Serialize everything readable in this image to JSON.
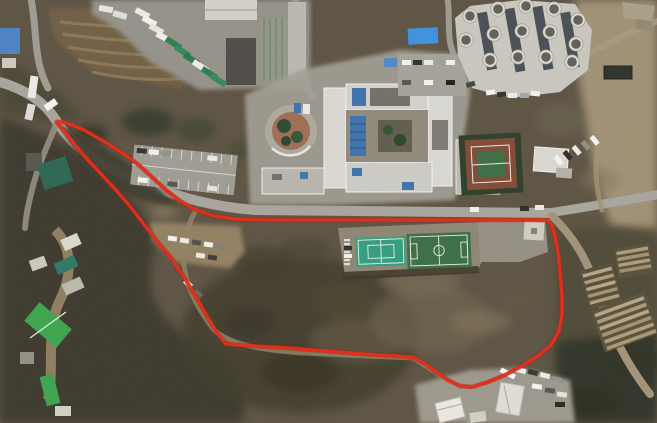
{
  "map": {
    "kind": "satellite-aerial-photo",
    "description": "Aerial photograph of a hillside campus with a main building complex, round-tank facility, tennis court, sports fields and farm plots, overlaid with a red site-boundary outline",
    "canvas": {
      "width": 657,
      "height": 423
    }
  },
  "boundary": {
    "label": "site-boundary-outline",
    "color": "#e2301c",
    "underlay_color": "#8c1d10",
    "stroke_width": 3.4,
    "points": "57,122 63,122 72,125 84,130 98,138 113,147 127,156 140,166 153,178 166,190 180,201 196,210 214,216 236,219 268,220 548,220 552,226 555,236 558,252 560,272 562,295 562,314 559,331 551,345 538,356 522,366 505,375 488,382 472,387 460,386 448,380 436,372 424,363 414,358 396,356 362,354 326,351 288,348 254,346 226,344 217,333 207,316 196,297 184,277 171,258 157,241 143,223 129,205 115,189 101,174 88,160 76,146 66,133 59,125 57,122"
  },
  "features": {
    "terrain": {
      "label": "scrub hillside",
      "base_color": "#5b5244",
      "dark_color": "#38352b",
      "bare_color": "#9c8d72"
    },
    "roads": {
      "label": "access roads",
      "color": "#a4a19a",
      "dirt_color": "#9c8f76"
    },
    "main_building": {
      "label": "main building complex",
      "roof_color": "#d6d5cf",
      "solar_color": "#3f6fa8",
      "courtyard_color": "#8b8578"
    },
    "tank_facility": {
      "label": "round tank facility",
      "pad_color": "#c6c4bc",
      "tank_rim_color": "#d8d6cf",
      "tank_color": "#5f5d57"
    },
    "soccer_field": {
      "label": "soccer field",
      "turf_color": "#3c6b45",
      "line_color": "#dfe8dc"
    },
    "futsal_court": {
      "label": "futsal court",
      "turf_color": "#35997b",
      "line_color": "#e4efe7"
    },
    "tennis_court": {
      "label": "tennis court",
      "surface_color": "#7c4a38",
      "infield_color": "#3d6b44"
    },
    "greenhouses": {
      "label": "green-roof farm buildings",
      "roof_color": "#3da04e"
    },
    "blue_roofs": {
      "label": "blue roofed sheds",
      "roof_color": "#3e8edd"
    },
    "parking": {
      "label": "parking lots",
      "color": "#9a988f"
    },
    "vehicle_yard": {
      "label": "bottom vehicle yard",
      "color": "#98948a"
    }
  }
}
